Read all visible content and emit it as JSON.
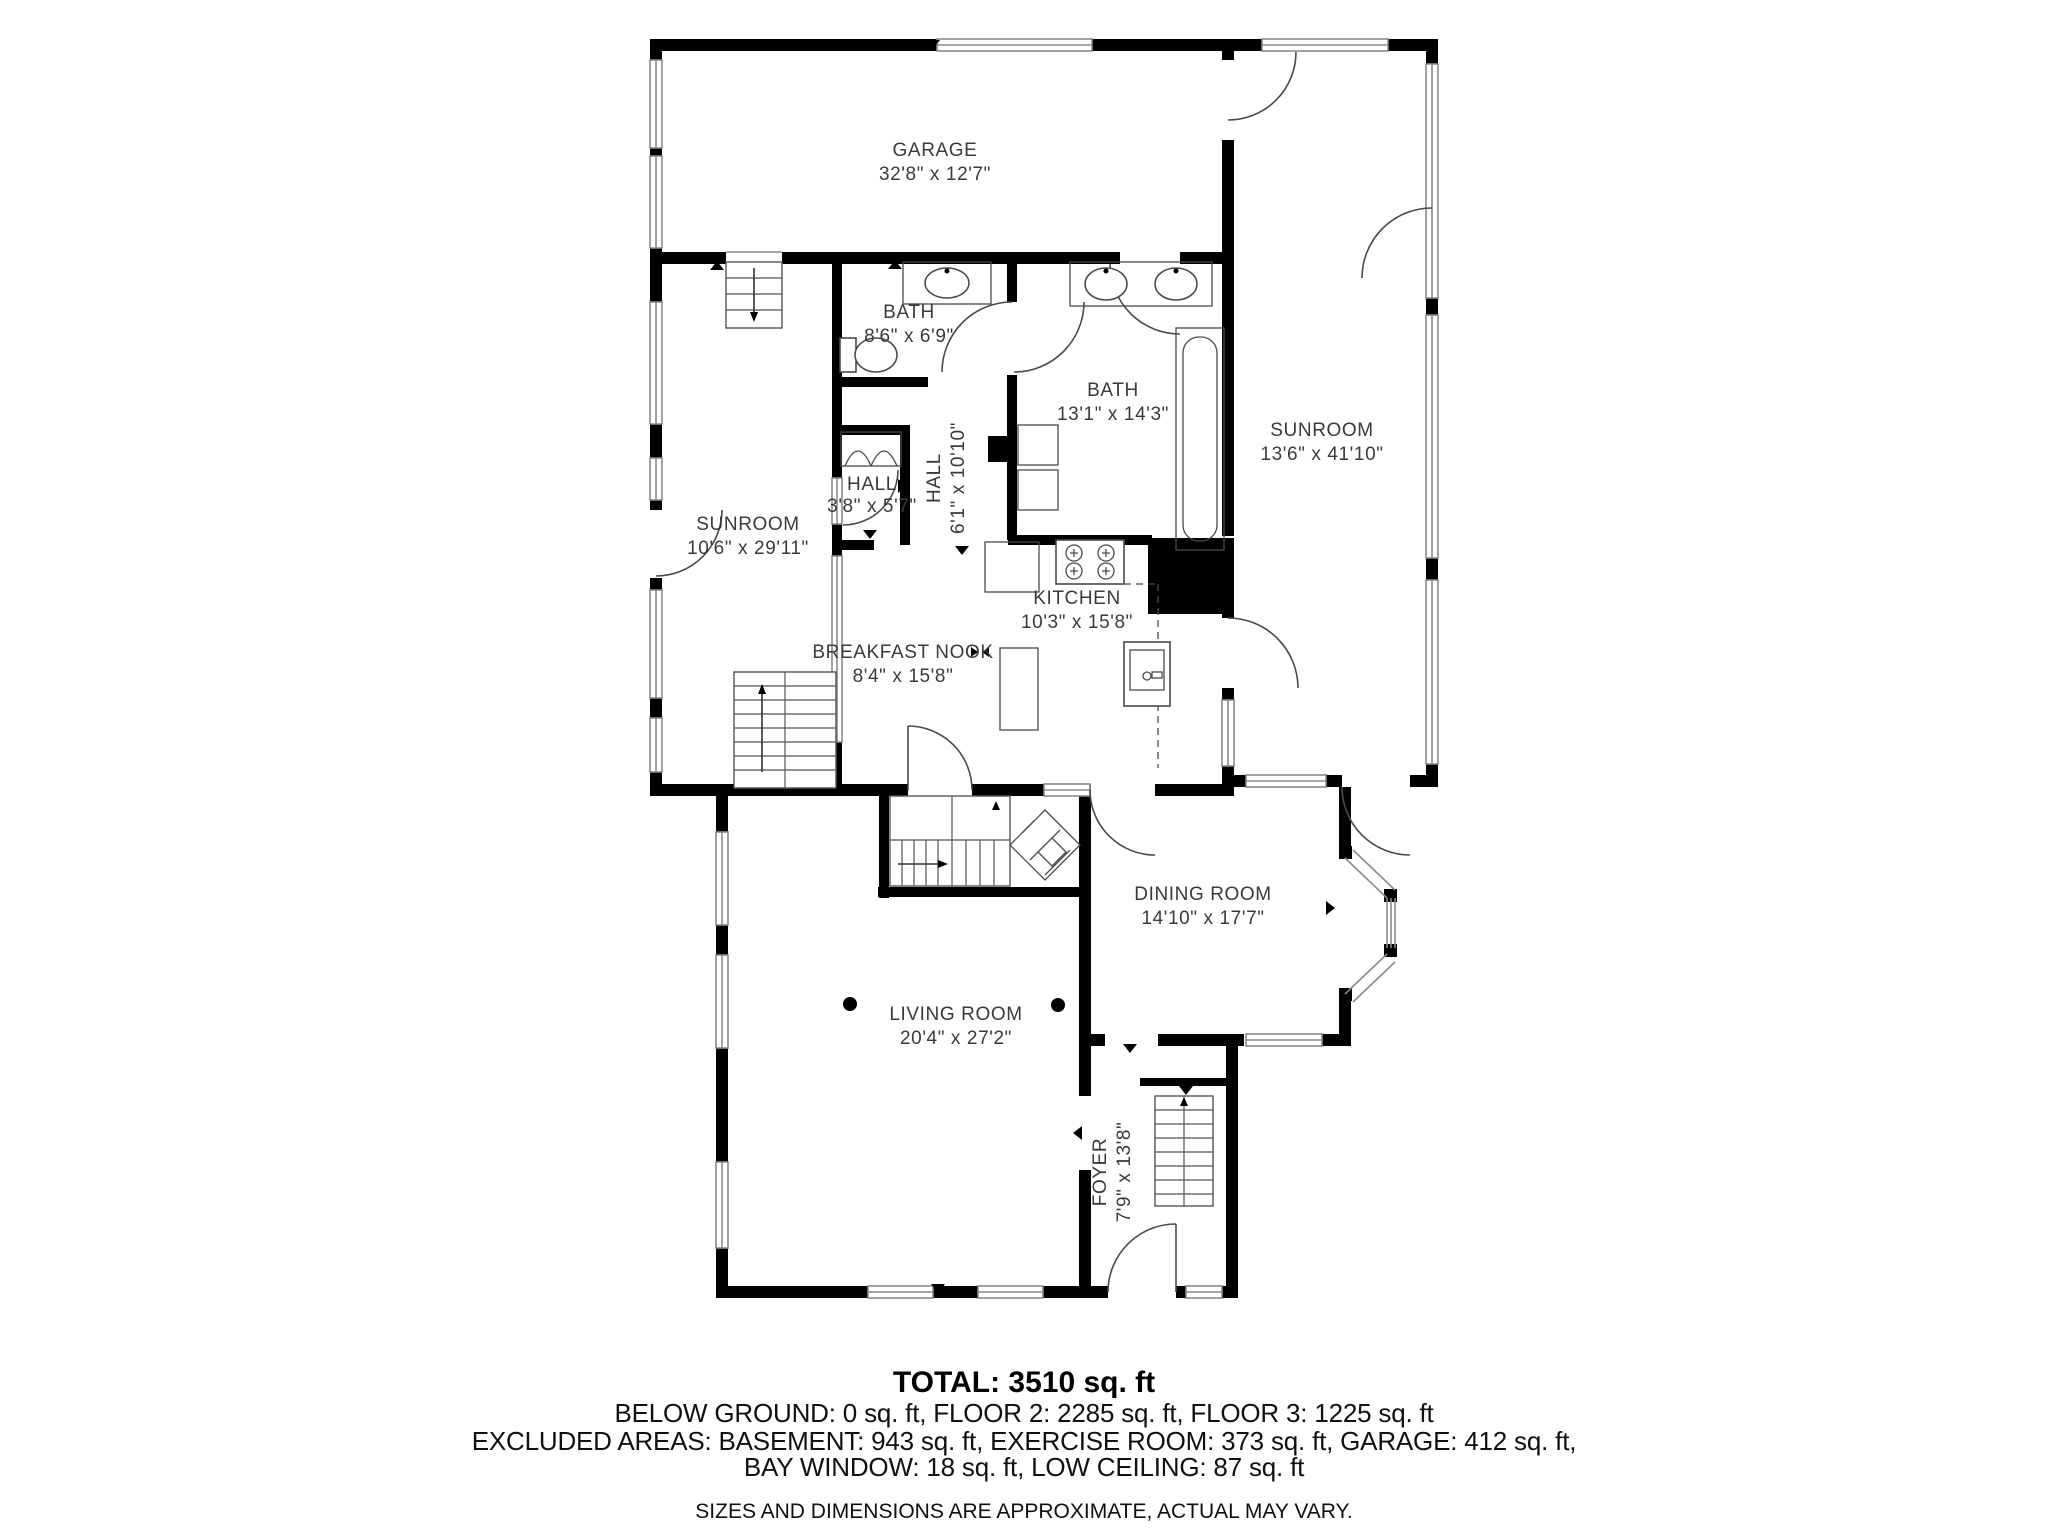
{
  "floor_plan": {
    "rooms": {
      "garage": {
        "name": "GARAGE",
        "dims": "32'8\" x 12'7\""
      },
      "bath_small": {
        "name": "BATH",
        "dims": "8'6\" x 6'9\""
      },
      "bath_large": {
        "name": "BATH",
        "dims": "13'1\" x 14'3\""
      },
      "sunroom_right": {
        "name": "SUNROOM",
        "dims": "13'6\" x 41'10\""
      },
      "sunroom_left": {
        "name": "SUNROOM",
        "dims": "10'6\" x 29'11\""
      },
      "hall_small": {
        "name": "HALL",
        "dims": "3'8\" x 5'7\""
      },
      "hall_long": {
        "name": "HALL",
        "dims": "6'1\" x 10'10\""
      },
      "kitchen": {
        "name": "KITCHEN",
        "dims": "10'3\" x 15'8\""
      },
      "breakfast_nook": {
        "name": "BREAKFAST NOOK",
        "dims": "8'4\" x 15'8\""
      },
      "dining_room": {
        "name": "DINING ROOM",
        "dims": "14'10\" x 17'7\""
      },
      "living_room": {
        "name": "LIVING ROOM",
        "dims": "20'4\" x 27'2\""
      },
      "foyer": {
        "name": "FOYER",
        "dims": "7'9\" x 13'8\""
      }
    },
    "summary": {
      "total": "TOTAL: 3510 sq. ft",
      "floors": "BELOW GROUND: 0 sq. ft, FLOOR 2: 2285 sq. ft, FLOOR 3: 1225 sq. ft",
      "excluded": "EXCLUDED AREAS: BASEMENT: 943 sq. ft, EXERCISE ROOM: 373 sq. ft, GARAGE: 412 sq. ft,",
      "excluded2": "BAY WINDOW: 18 sq. ft, LOW CEILING: 87 sq. ft",
      "disclaimer": "SIZES AND DIMENSIONS ARE APPROXIMATE, ACTUAL MAY VARY."
    },
    "colors": {
      "wall": "#000000",
      "background": "#ffffff",
      "label": "#3a3a3a",
      "fixture": "#4a4a4a"
    },
    "icons": [
      "stairs",
      "door-arc",
      "window",
      "toilet",
      "sink",
      "double-sink",
      "bathtub",
      "stove",
      "kitchen-island",
      "closet",
      "diamond-tile",
      "column-dot"
    ]
  }
}
